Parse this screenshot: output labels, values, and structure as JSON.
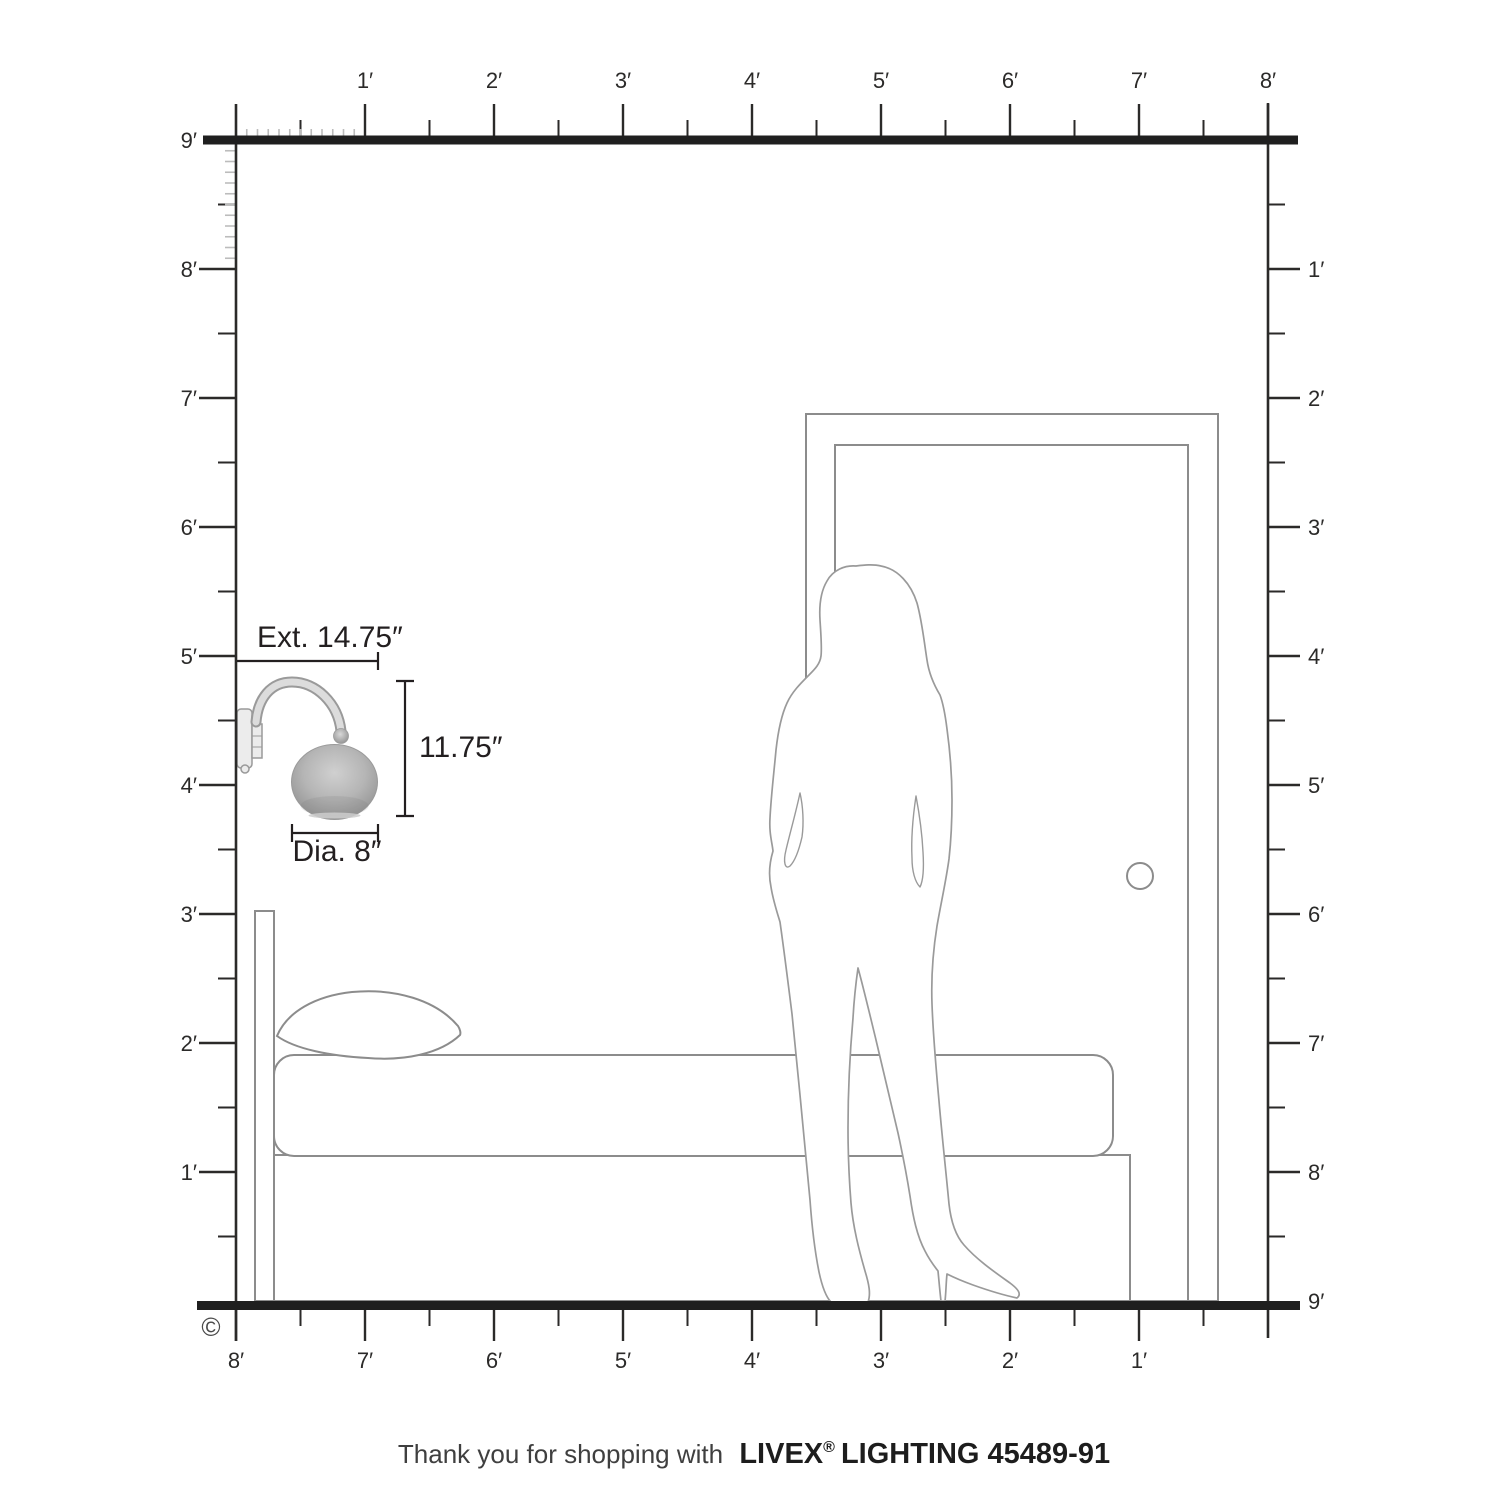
{
  "rulers": {
    "top": {
      "labels": [
        "1′",
        "2′",
        "3′",
        "4′",
        "5′",
        "6′",
        "7′",
        "8′"
      ]
    },
    "left": {
      "labels": [
        "9′",
        "8′",
        "7′",
        "6′",
        "5′",
        "4′",
        "3′",
        "2′",
        "1′"
      ]
    },
    "right": {
      "labels": [
        "1′",
        "2′",
        "3′",
        "4′",
        "5′",
        "6′",
        "7′",
        "8′",
        "9′"
      ]
    },
    "bottom": {
      "labels": [
        "8′",
        "7′",
        "6′",
        "5′",
        "4′",
        "3′",
        "2′",
        "1′"
      ]
    }
  },
  "annotations": {
    "extension": "Ext. 14.75″",
    "height": "11.75″",
    "diameter": "Dia. 8″"
  },
  "copyright_symbol": "©",
  "footer": {
    "prefix": "Thank you for shopping with",
    "brand": "LIVEX",
    "registered": "®",
    "suffix": "LIGHTING 45489-91"
  },
  "scene_items": [
    "wall-sconce",
    "bed",
    "pillow",
    "person-silhouette",
    "door"
  ],
  "colors": {
    "ink": "#231f20",
    "ruler": "#2b2a29",
    "bar": "#1f1f1f",
    "outline": "#8c8c8c",
    "silhouette": "#9a9a9a",
    "minor_tick": "#bcbcbc",
    "footer_light": "#3f3f3f",
    "footer_bold": "#1d1d1d",
    "sconce_light": "#d0d0d0",
    "sconce_dark": "#8e8e8e"
  }
}
